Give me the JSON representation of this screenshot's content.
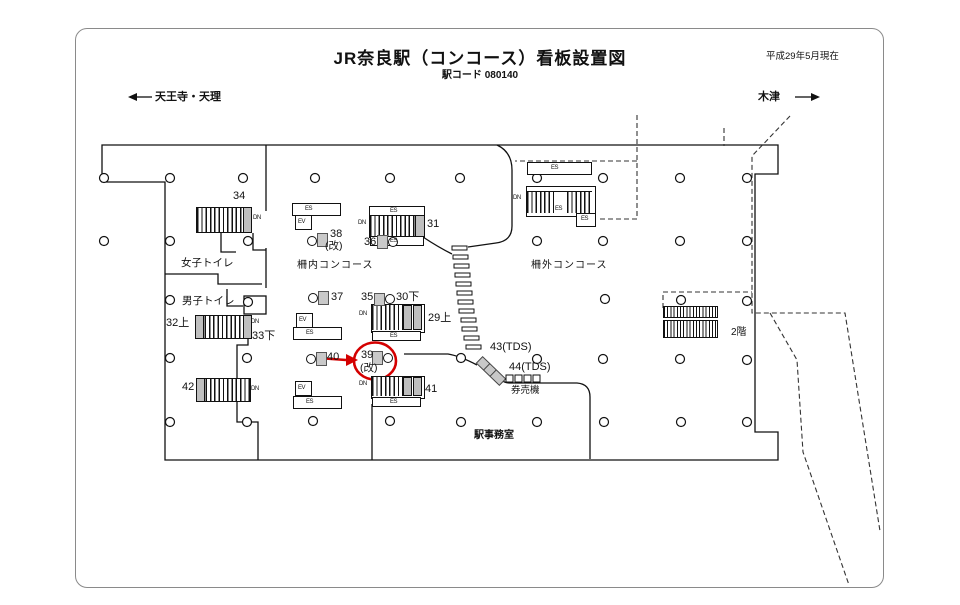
{
  "header": {
    "title": "JR奈良駅（コンコース）看板設置図",
    "station_code_label": "駅コード 080140",
    "date_note": "平成29年5月現在"
  },
  "directions": {
    "left": "天王寺・天理",
    "right": "木津"
  },
  "areas": {
    "female_toilet": "女子トイレ",
    "male_toilet": "男子トイレ",
    "inside_concourse": "柵内コンコース",
    "outside_concourse": "柵外コンコース",
    "ticket_machines": "券売機",
    "station_office": "駅事務室",
    "second_floor": "2階"
  },
  "signs": {
    "s34": "34",
    "s38": "38",
    "s38_note": "(改)",
    "s36": "36",
    "s31": "31",
    "s37": "37",
    "s35": "35",
    "s30": "30下",
    "s29": "29上",
    "s40": "40",
    "s39": "39",
    "s39_note": "(改)",
    "s41": "41",
    "s32": "32上",
    "s33": "33下",
    "s42": "42",
    "s43": "43(TDS)",
    "s44": "44(TDS)"
  },
  "glyphs": {
    "dn": "DN",
    "es": "ES",
    "ev": "EV"
  },
  "colors": {
    "highlight": "#d40000",
    "wall": "#111111",
    "stair_cap": "#bfbfbf"
  }
}
